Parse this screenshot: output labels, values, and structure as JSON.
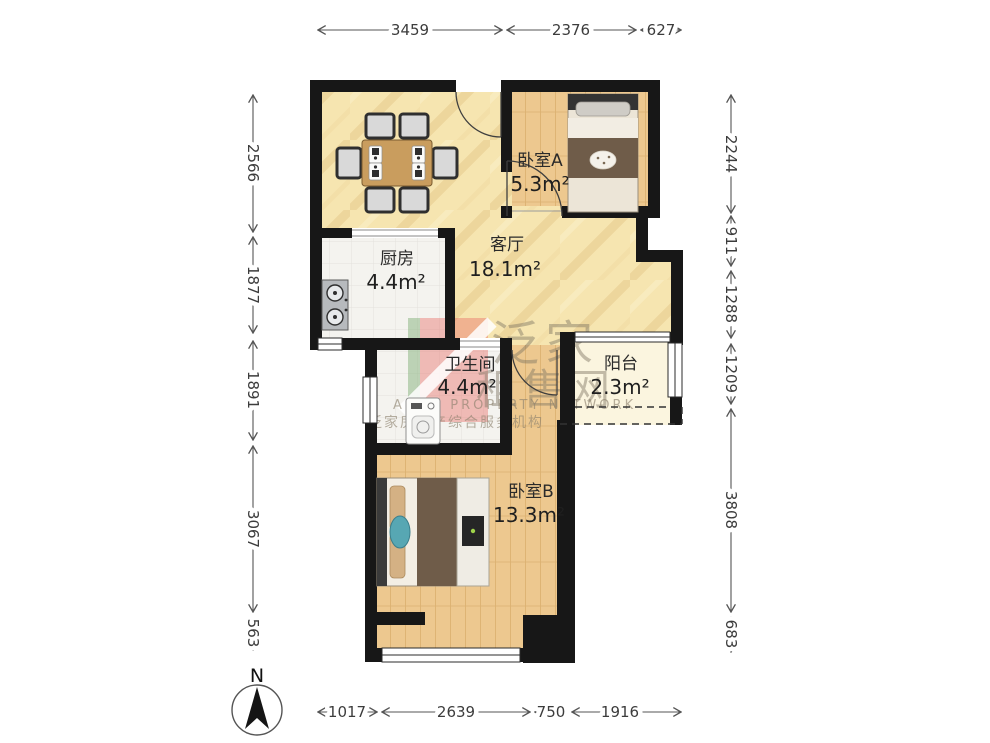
{
  "rooms": {
    "bedroom_a": {
      "name": "卧室A",
      "area": "5.3m²"
    },
    "living": {
      "name": "客厅",
      "area": "18.1m²"
    },
    "kitchen": {
      "name": "厨房",
      "area": "4.4m²"
    },
    "bathroom": {
      "name": "卫生间",
      "area": "4.4m²"
    },
    "balcony": {
      "name": "阳台",
      "area": "2.3m²"
    },
    "bedroom_b": {
      "name": "卧室B",
      "area": "13.3m²"
    }
  },
  "dimensions_mm": {
    "top": [
      "3459",
      "2376",
      "627"
    ],
    "left": [
      "2566",
      "1877",
      "1891",
      "3067",
      "563"
    ],
    "right": [
      "2244",
      "911",
      "1288",
      "1209",
      "3808",
      "683"
    ],
    "bottom": [
      "1017",
      "2639",
      "750",
      "1916"
    ]
  },
  "compass": {
    "label": "N"
  },
  "watermark": {
    "brand_line1": "泛家",
    "brand_line2": "租售网",
    "english": "ANJIA PROPERTY NETWORK",
    "caption": "泛家房地产综合服务机构"
  },
  "colors": {
    "wall": "#171717",
    "living_floor": "#f6e5b0",
    "wood_floor": "#edc88f",
    "tile_floor": "#f4f3ef",
    "balcony_floor": "#fbf5df",
    "dimension": "#555555"
  }
}
